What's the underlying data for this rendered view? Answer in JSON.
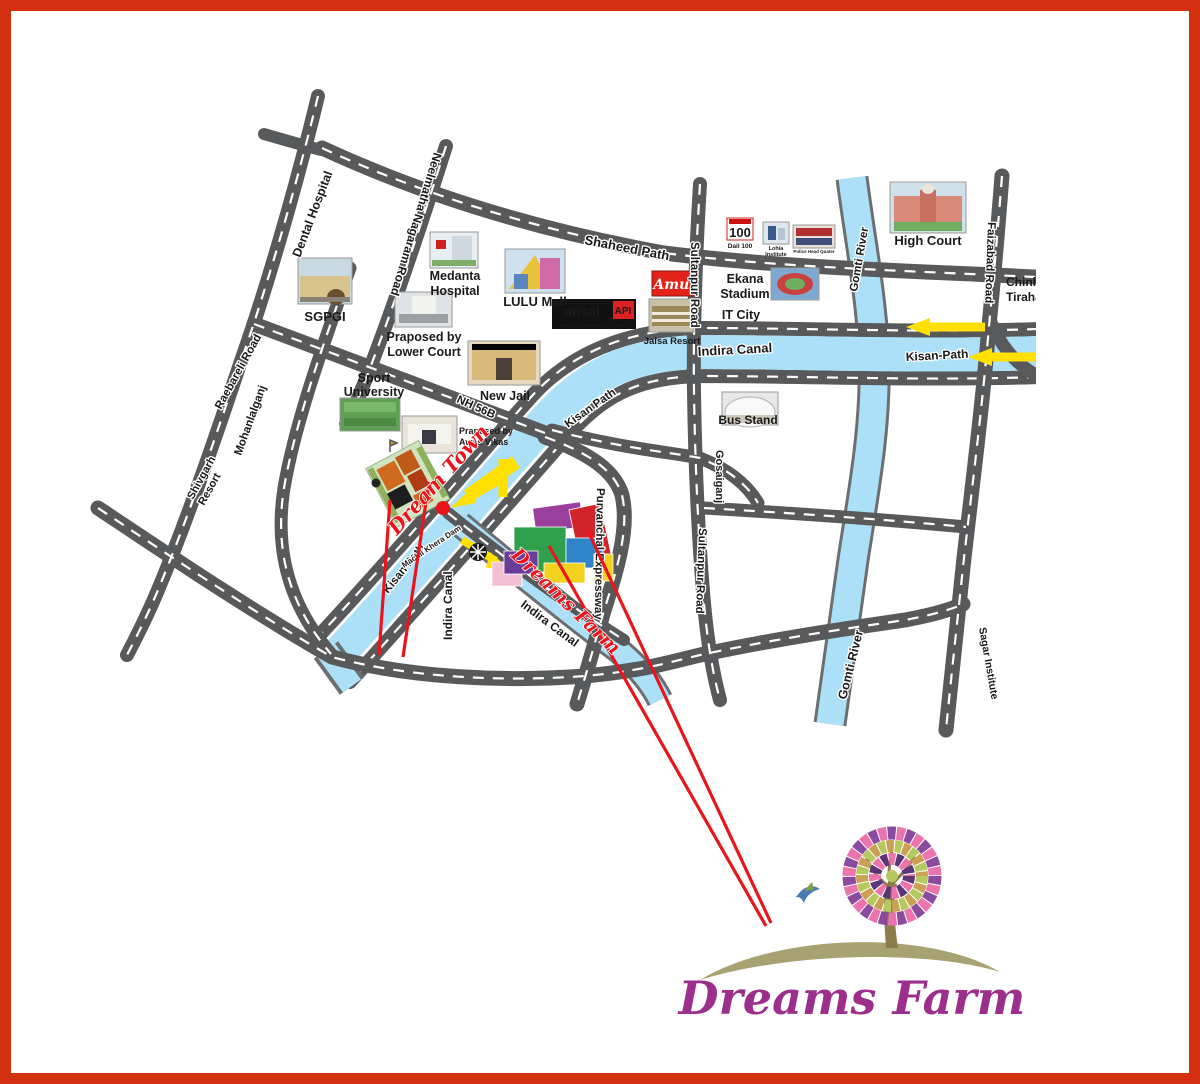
{
  "colors": {
    "border": "#D2300E",
    "road_gray": "#58595B",
    "water_blue": "#ABE0F8",
    "highlight_red": "#E8151C",
    "arrow_yellow": "#FFE000",
    "logo_purple": "#9C2E8C",
    "bus_stand_blue": "#3D53A4"
  },
  "roads": {
    "shaheed": "Shaheed Path",
    "kisan_diag": "Kisan Path",
    "kisan_mid": "Kisan Path",
    "kisan_east": "Kisan-Path",
    "nh56b": "NH 56B",
    "neelmatha": "Neelmatha Nagaram Road",
    "raebareli": "Raebareli Road",
    "sultanpur_top": "Sultanpur Road",
    "sultanpur_bottom": "Sultanpur Road",
    "faizabad": "Faizabad Road",
    "purvanchal": "Purvanchal Expressway"
  },
  "water": {
    "indira_main": "Indira Canal",
    "indira_branch": "Indira Canal",
    "indira_vert": "Indira Canal",
    "gomti_upper": "Gomti River",
    "gomti_lower": "Gomti River",
    "dam": "Machli Khera Dam"
  },
  "places": {
    "dental": "Dental Hospital",
    "sgpgi": "SGPGI",
    "medanta": [
      "Medanta",
      "Hospital"
    ],
    "lulu": "LULU Mall",
    "ansal": {
      "name": "ansal",
      "api": "API",
      "tagline": "Building Lifestyles since 1967"
    },
    "lower_court": [
      "Praposed by",
      "Lower Court"
    ],
    "sport": [
      "Sport",
      "University"
    ],
    "new_jail": "New Jail",
    "awas": [
      "Praposed by",
      "Awas Vikas"
    ],
    "amul": "Amul",
    "jalsa": "Jalsa Resort",
    "ekana": [
      "Ekana",
      "Stadium"
    ],
    "it_city": "IT City",
    "dail100": {
      "logo": "100",
      "label": "Dail 100"
    },
    "lohia": [
      "Lohia",
      "Institute"
    ],
    "police": "Police Head Quater",
    "high_court": "High Court",
    "bus_stand": "Bus Stand",
    "gosaiganj": "Gosaiganj",
    "mohanlalganj": "Mohanlalganj",
    "shivgarh": [
      "Shivgarh",
      "Resort"
    ],
    "sagar": "Sagar Institute",
    "chinhat": [
      "Chinhat",
      "Tiraha"
    ]
  },
  "sites": {
    "dream_town": "Dream Town",
    "dreams_farm": "Dreams Farm"
  },
  "logo": {
    "name": "Dreams Farm"
  }
}
